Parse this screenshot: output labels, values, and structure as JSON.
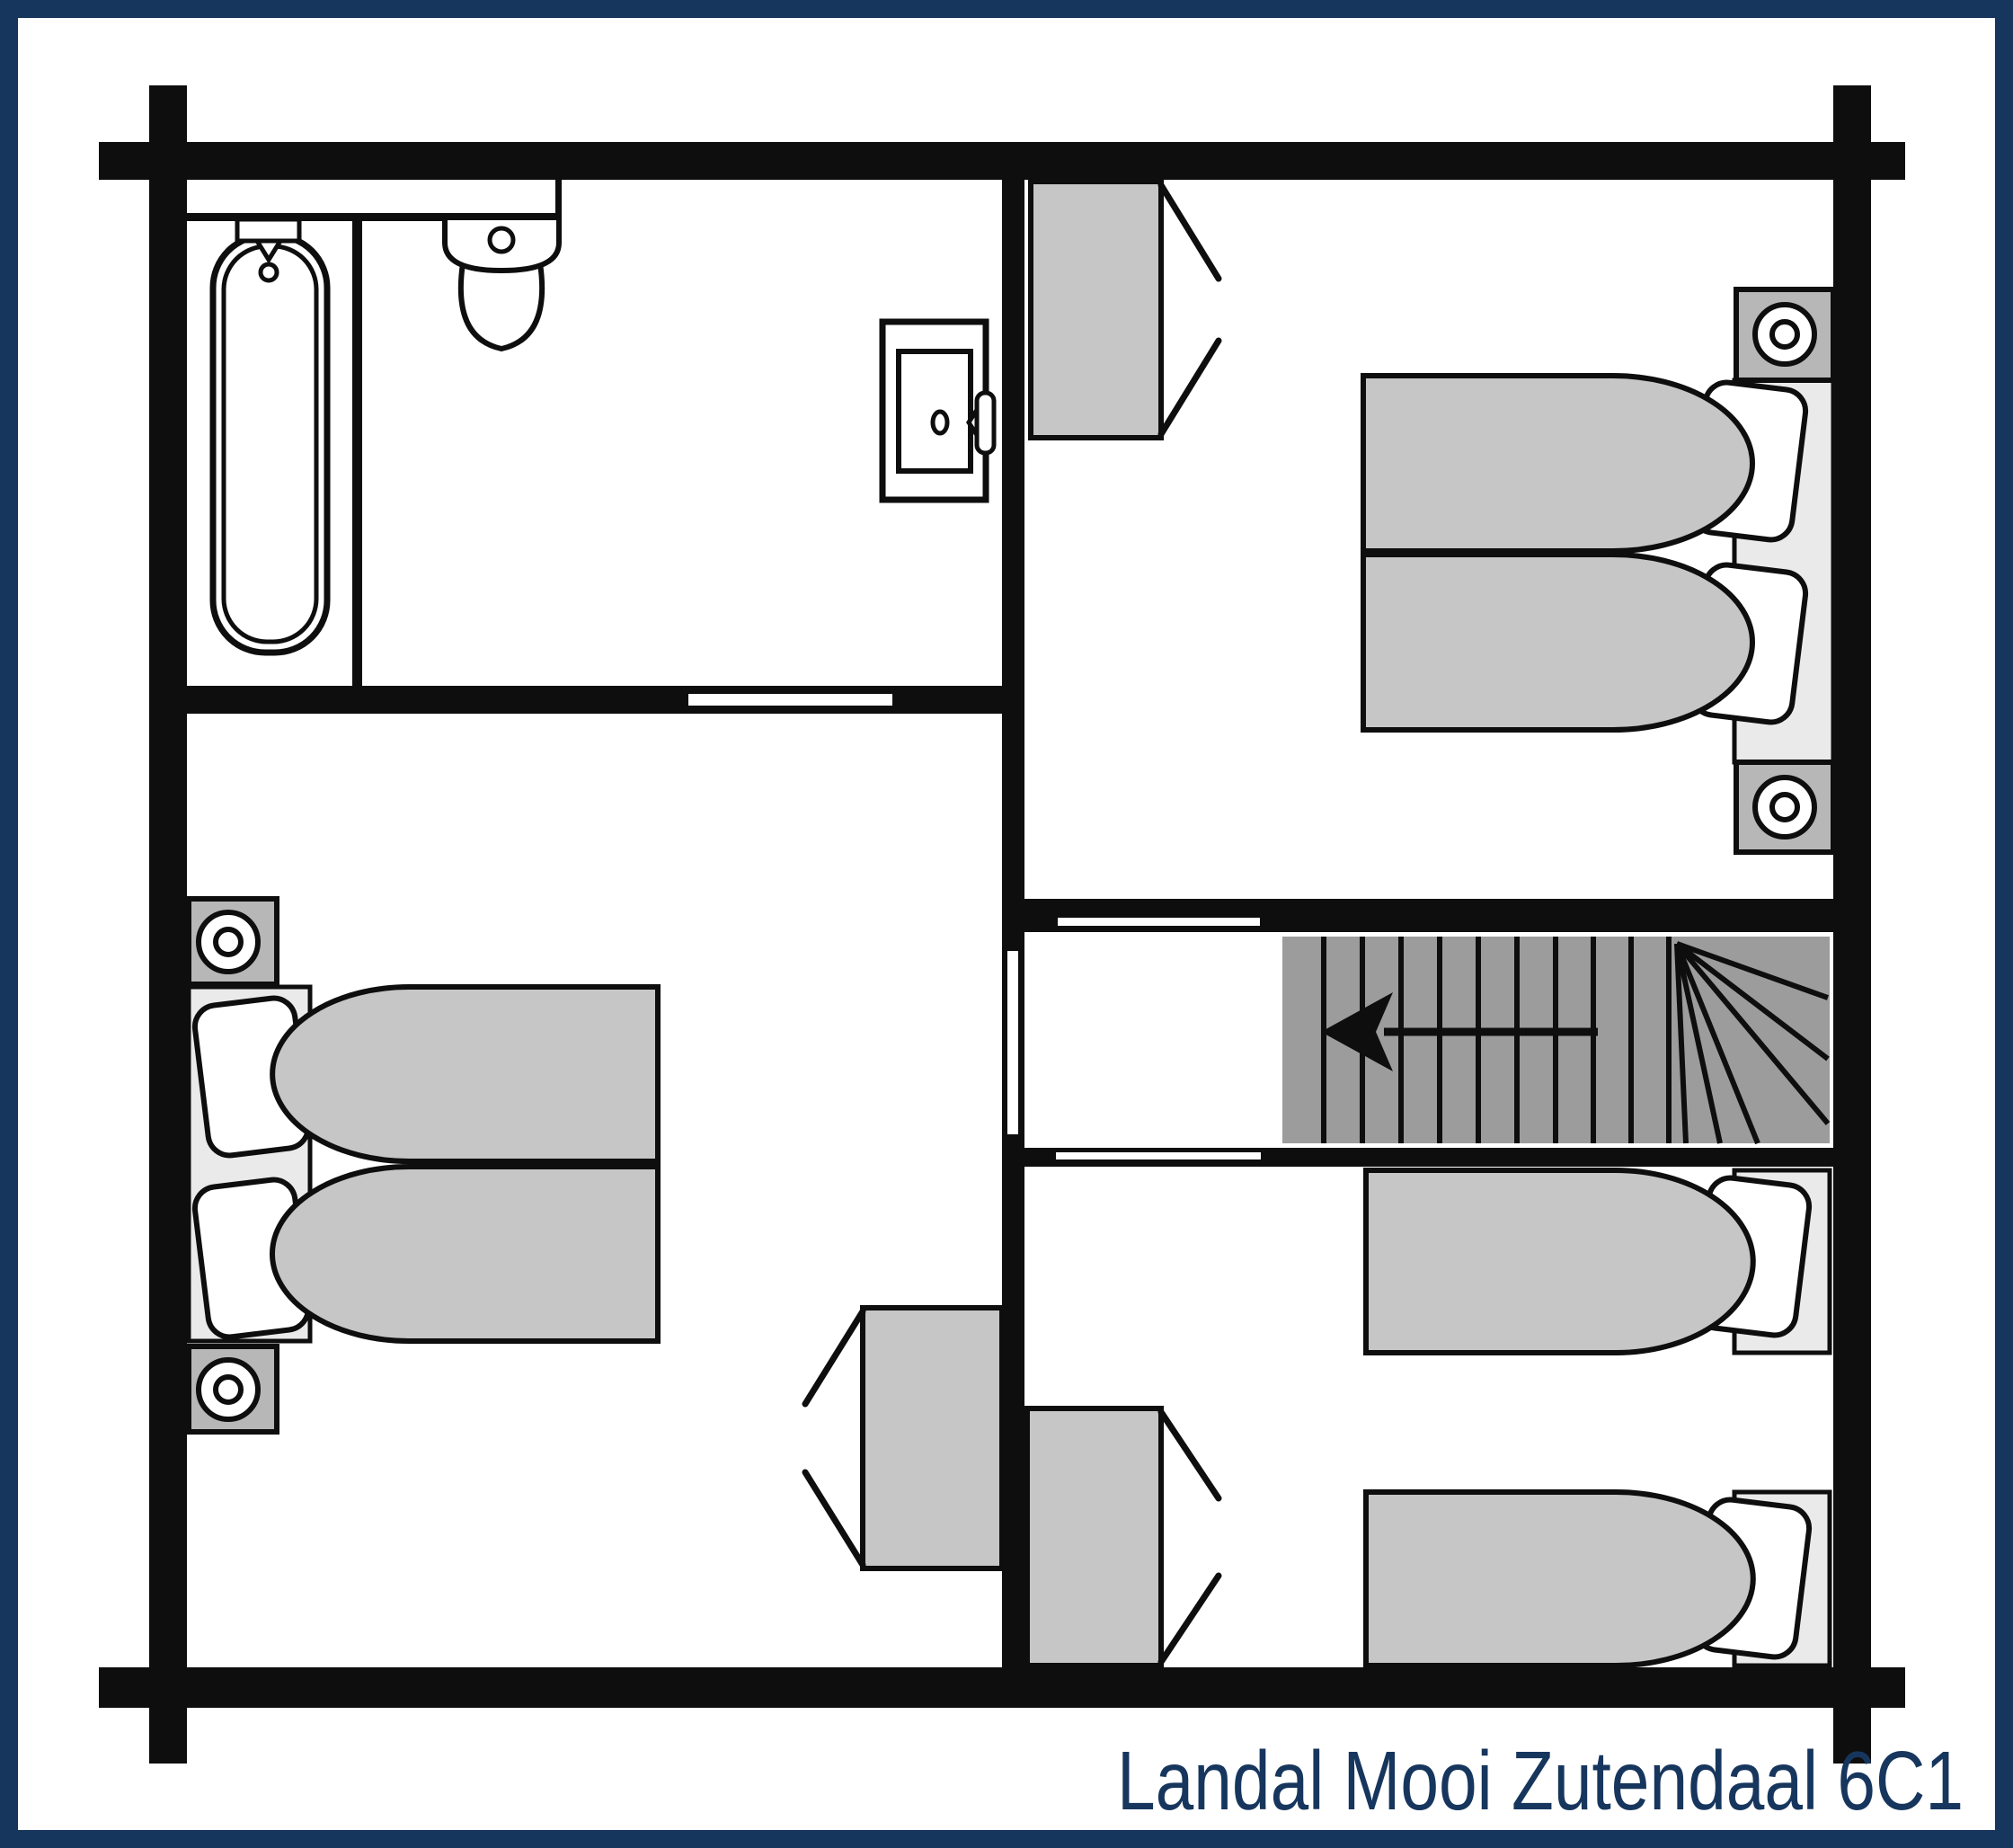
{
  "title": "Landal Mooi Zutendaal 6C1",
  "colors": {
    "navy": "#17365d",
    "ink": "#0e0e0e",
    "paper": "#ffffff",
    "stairs": "#9c9c9c",
    "furniture": "#c6c6c6",
    "nightstand": "#b7b7b7",
    "bed_base": "#eaeaea"
  },
  "plan": {
    "type": "floor-plan",
    "border": "navy frame around page",
    "rooms": [
      {
        "name": "bathroom",
        "position": "top-left",
        "fixtures": [
          "bathtub-with-taps",
          "toilet",
          "wall-cabinet-with-door-knob-and-latch",
          "partition-wall"
        ]
      },
      {
        "name": "bedroom-top-right",
        "position": "top-right",
        "furniture": [
          "wardrobe-with-open-doors",
          "double-bed-two-duvets",
          "two-pillows",
          "nightstand-with-lamp-upper",
          "nightstand-with-lamp-lower"
        ]
      },
      {
        "name": "bedroom-bottom-left",
        "position": "bottom-left",
        "furniture": [
          "double-bed-two-duvets",
          "two-pillows",
          "nightstand-with-lamp-upper",
          "nightstand-with-lamp-lower",
          "wardrobe-with-open-doors"
        ]
      },
      {
        "name": "bedroom-bottom-right",
        "position": "bottom-right",
        "furniture": [
          "single-bed-upper",
          "single-bed-lower",
          "two-pillows",
          "wardrobe-with-open-doors"
        ]
      },
      {
        "name": "landing-with-staircase",
        "position": "center-right",
        "fixtures": [
          "straight-stair-treads",
          "winder-treads-fan",
          "direction-arrow"
        ]
      }
    ],
    "stairs": {
      "arrow_direction": "left",
      "winders": "top-right corner fan"
    },
    "door_openings": [
      "bathroom-south-wall",
      "landing-to-bedroom-top-right",
      "landing-to-bedroom-bottom-right",
      "landing-to-bottom-left-area"
    ]
  }
}
